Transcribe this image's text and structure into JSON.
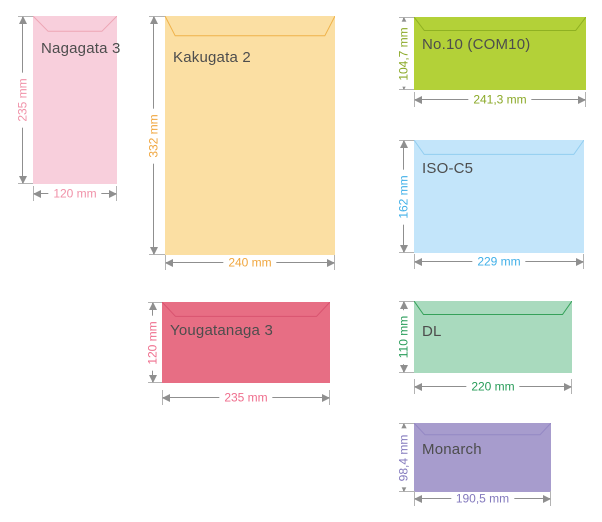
{
  "diagram": {
    "subject": "Envelope sizes",
    "unit": "mm"
  },
  "styles": {
    "background": "#ffffff",
    "dimension_line_color": "#8f8f8f",
    "extension_tick_color": "#b3b3b3",
    "envelope_name_color": "#4d4d4d"
  },
  "envelopes": [
    {
      "label": "Nagagata 3",
      "height_label": "235 mm",
      "width_label": "120 mm",
      "fill": "#f8cfdc",
      "flap_stroke": "#eda5b4",
      "accent": "#f091a8"
    },
    {
      "label": "Kakugata 2",
      "height_label": "332 mm",
      "width_label": "240 mm",
      "fill": "#fbdfa3",
      "flap_stroke": "#efb24a",
      "accent": "#f0a63e"
    },
    {
      "label": "Yougatanaga 3",
      "height_label": "120 mm",
      "width_label": "235 mm",
      "fill": "#e76e84",
      "flap_stroke": "#d95470",
      "accent": "#ef6e8d"
    },
    {
      "label": "No.10 (COM10)",
      "height_label": "104,7 mm",
      "width_label": "241,3 mm",
      "fill": "#b3d138",
      "flap_stroke": "#8fb122",
      "accent": "#8ba928"
    },
    {
      "label": "ISO-C5",
      "height_label": "162 mm",
      "width_label": "229 mm",
      "fill": "#c3e5fa",
      "flap_stroke": "#93cef0",
      "accent": "#41b0e8"
    },
    {
      "label": "DL",
      "height_label": "110 mm",
      "width_label": "220 mm",
      "fill": "#a9dabe",
      "flap_stroke": "#35a15a",
      "accent": "#289c59"
    },
    {
      "label": "Monarch",
      "height_label": "98,4 mm",
      "width_label": "190,5 mm",
      "fill": "#a79ccd",
      "flap_stroke": "#9488c4",
      "accent": "#8379bd"
    }
  ]
}
